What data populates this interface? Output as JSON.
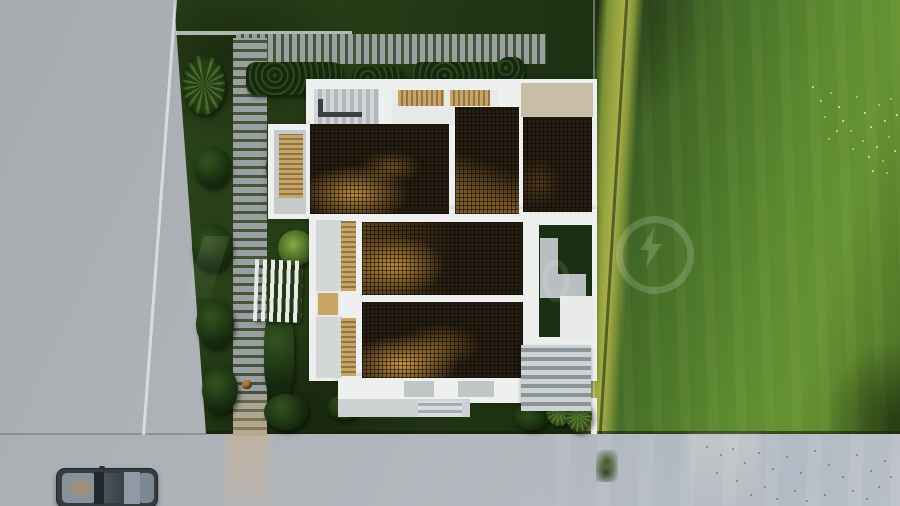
{
  "meta": {
    "width_px": 900,
    "height_px": 506,
    "view": "top-down aerial 3D architectural rendering"
  },
  "scene": {
    "description": "Aerial top-down 3D render of a modern flat-roof house with dark wooden pergola lattice roof panels and tan slatted skylights, surrounded by a landscaped garden with a stepping-stone path, hedges, a white picket fence, shrubs and agaves; a bright green lawn with a diagonal band of tall sunlit grass and tiny wildflowers on the right; light gray concrete pavement on the left and a sidewalk along the bottom with a parked dark car, a sunlight streak and scattered leaf debris; a faint semi-transparent watermark with a lightning-bolt-in-circle emblem overlays the middle.",
    "objects": [
      "concrete-pavement",
      "parked-car",
      "stepping-stone-path",
      "boardwalk",
      "hedges",
      "yucca-plant",
      "picket-fence",
      "fern",
      "agave-plants",
      "house-white-walls",
      "pergola-lattice-roof-panels",
      "wood-slat-skylights",
      "beige-roof-terrace",
      "inner-grass-courtyard",
      "outdoor-staircase",
      "lawn",
      "tall-grass-band",
      "wildflowers",
      "leaf-debris",
      "sapling",
      "watermark-emblem"
    ],
    "watermark": {
      "emblem": "lightning-bolt-in-circle",
      "style": "semi-transparent white overlay"
    }
  },
  "palette": {
    "pavement": "#a6abb0",
    "pavement_hi": "#bdc2c9",
    "garden": "#233a15",
    "lawn": "#4a7429",
    "lawn_hi": "#659232",
    "lawn_dark": "#2f4d1e",
    "tallgrass": "#9aa63f",
    "slat": "#99a0a2",
    "slat_gap": "#46543a",
    "hedge": "#16280e",
    "hedge_hi": "#2c4a1b",
    "wall": "#eef0f0",
    "roof_dark": "#261d11",
    "roof_sun": "#d19a45",
    "wood": "#c9a565",
    "wood_dark": "#927449",
    "terr_beige": "#c8bea8",
    "stair_tread": "#ccd2d4",
    "stair_riser": "#8b9499",
    "court_green": "#1b2f12",
    "court_path": "#b9bfc0",
    "car_body": "#363d41",
    "car_glass": "#85919c",
    "car_reflect": "#a98d6f",
    "wm": "rgba(255,255,255,0.17)",
    "flower": "#e6e3ba",
    "flower2": "#cfc470",
    "debris": "rgba(86,92,58,0.65)"
  }
}
